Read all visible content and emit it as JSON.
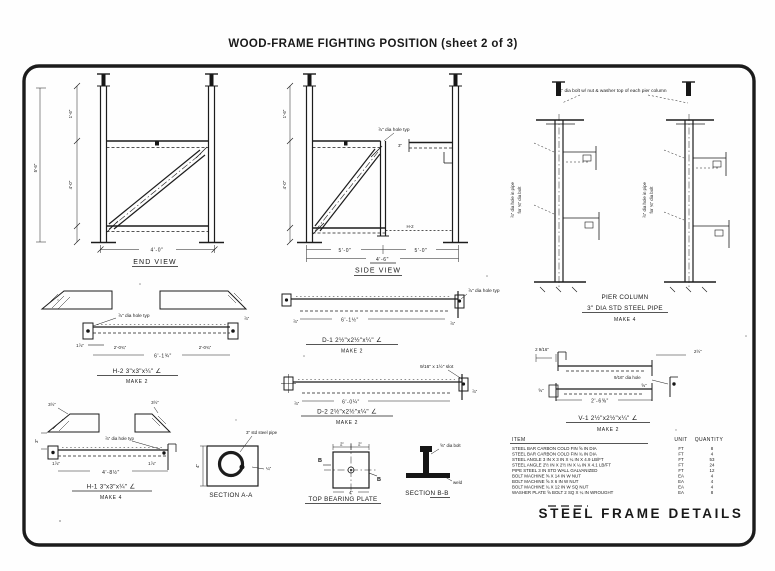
{
  "page": {
    "title": "WOOD-FRAME FIGHTING POSITION (sheet 2 of 3)",
    "drawing_title": "STEEL FRAME DETAILS"
  },
  "end_view": {
    "label": "END VIEW",
    "dim_width": "4'-0\"",
    "dim_height_top": "1'-6\"",
    "dim_height_bottom": "4'-0\"",
    "dim_height_total": "5'-6\""
  },
  "side_view": {
    "label": "SIDE VIEW",
    "note": "⅞\" dia hole typ",
    "stub_dim": "3\"",
    "member_tag": "H-2",
    "dim_left_bay": "5'-0\"",
    "dim_right_bay": "5'-0\"",
    "dim_center": "4'-6\"",
    "dim_height_top": "1'-6\"",
    "dim_height_bottom": "4'-0\""
  },
  "pier_column": {
    "note_top": "¾\" dia bolt w/ nut & washer top of each pier column",
    "note_hole_1": "⅞\" dia hole in pipe",
    "note_hole_2": "for ¾\" dia bolt",
    "label_line1": "PIER COLUMN",
    "label_line2": "3\" DIA STD STEEL PIPE",
    "make": "MAKE 4"
  },
  "details": {
    "h2": {
      "title": "H-2  3\"x3\"x¼\" ∠",
      "make": "MAKE 2",
      "note": "⅞\" dia hole typ",
      "dim_end_left": "1⅞\"",
      "dim_seg_left": "2'-0¾\"",
      "dim_total": "6'-1¾\"",
      "dim_seg_right": "2'-0¾\"",
      "dim_side": "⅞\""
    },
    "d1": {
      "title": "D-1  2½\"x2½\"x¼\" ∠",
      "make": "MAKE 2",
      "note": "⅞\" dia hole typ",
      "dim_total": "6'-1½\"",
      "dim_end_left": "⅞\"",
      "dim_end_right": "⅞\""
    },
    "d2": {
      "title": "D-2  2½\"x2½\"x¼\" ∠",
      "make": "MAKE 2",
      "note": "9/16\" x 1½\" slot",
      "dim_total": "6'-0¼\"",
      "dim_end_left": "⅞\"",
      "dim_end_right": "⅞\""
    },
    "v1": {
      "title": "V-1  2½\"x2½\"x¼\" ∠",
      "make": "MAKE 2",
      "note": "9/16\" dia hole",
      "dim_total": "2'-6⅝\"",
      "dim_top_left": "2 9/16\"",
      "dim_top_right": "2½\"",
      "dim_end_left": "⅝\"",
      "dim_end_right": "⅝\""
    },
    "h1": {
      "title": "H-1  3\"x3\"x¼\" ∠",
      "make": "MAKE 4",
      "note": "⅞\" dia hole typ",
      "dim_total": "4'-8½\"",
      "dim_top_left": "3½\"",
      "dim_top_right": "3½\"",
      "dim_end_left": "1⅞\"",
      "dim_end_right": "1⅞\"",
      "dim_side": "3\""
    }
  },
  "sections": {
    "a": {
      "label": "SECTION A-A",
      "note": "3\" std steel pipe",
      "weld": "¼\"",
      "dim_side": "4\""
    },
    "plate": {
      "label": "TOP BEARING PLATE",
      "dim_half": "2\"",
      "dim_full": "4\"",
      "cut_mark": "B"
    },
    "b": {
      "label": "SECTION B-B",
      "note": "⅝\" dia bolt",
      "weld_note": "weld"
    }
  },
  "bom": {
    "headers": {
      "item": "ITEM",
      "unit": "UNIT",
      "quantity": "QUANTITY"
    },
    "rows": [
      {
        "item": "STEEL BAR CARBON COLD FIN ⅝ IN DIA",
        "unit": "FT",
        "qty": "8"
      },
      {
        "item": "STEEL BAR CARBON COLD FIN ¾ IN DIA",
        "unit": "FT",
        "qty": "4"
      },
      {
        "item": "STEEL ANGLE 3 IN X 3 IN X ¼ IN X 4.9 LB/FT",
        "unit": "FT",
        "qty": "53"
      },
      {
        "item": "STEEL ANGLE 2½ IN X 2½ IN X ¼ IN X 4.1 LB/FT",
        "unit": "FT",
        "qty": "24"
      },
      {
        "item": "PIPE STEEL 3 IN STD WALL GALVANIZED",
        "unit": "FT",
        "qty": "12"
      },
      {
        "item": "BOLT MACHINE ⅝ X 14 IN W NUT",
        "unit": "EA",
        "qty": "4"
      },
      {
        "item": "BOLT MACHINE ⅝ X 6 IN W NUT",
        "unit": "EA",
        "qty": "4"
      },
      {
        "item": "BOLT MACHINE ¾ X 12 IN W SQ NUT",
        "unit": "EA",
        "qty": "4"
      },
      {
        "item": "WASHER PLATE ⅝ BOLT 2 SQ X ¼ IN WROUGHT",
        "unit": "EA",
        "qty": "8"
      }
    ]
  }
}
